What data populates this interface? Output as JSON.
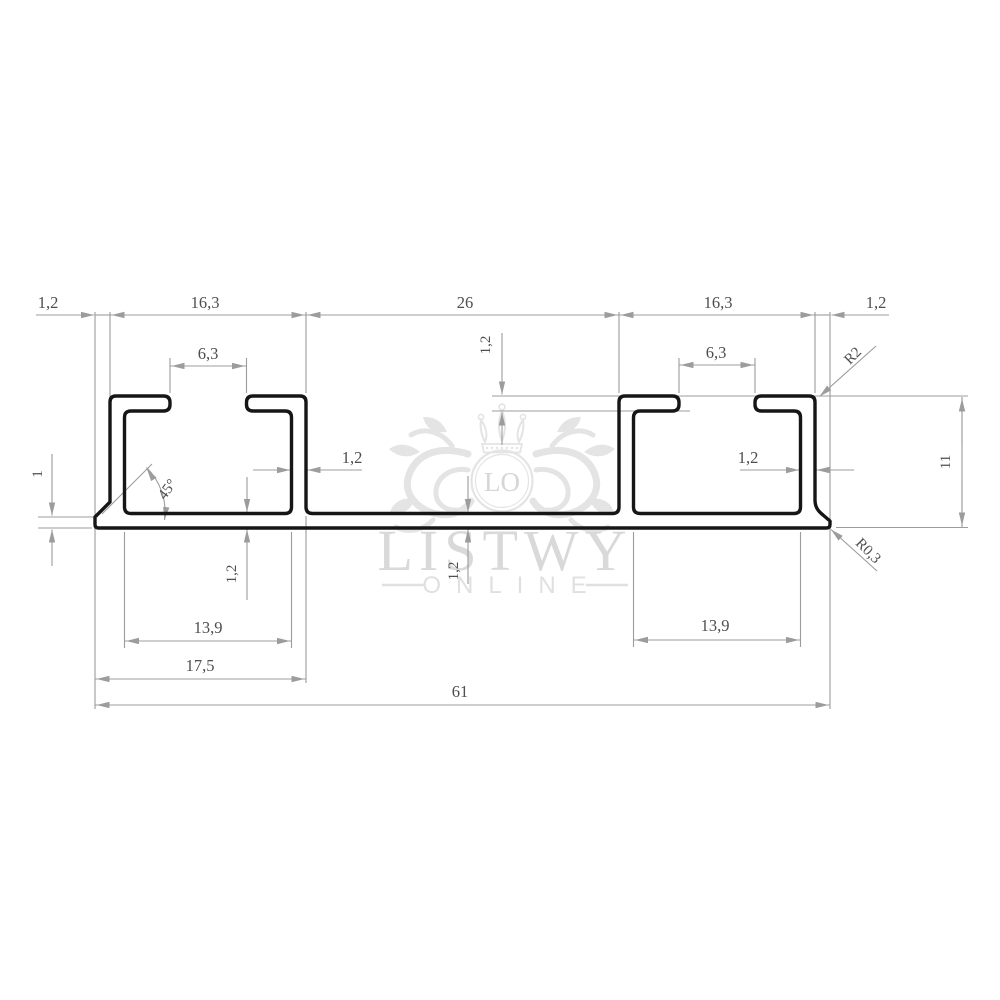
{
  "watermark": {
    "monogram": "LO",
    "brand": "LISTWY",
    "tagline": "ONLINE"
  },
  "dims": {
    "top_left_foot": "1,2",
    "top_left_channel": "16,3",
    "top_center_gap": "26",
    "top_right_channel": "16,3",
    "top_right_foot": "1,2",
    "left_opening": "6,3",
    "right_opening": "6,3",
    "lip_thickness": "1,2",
    "left_wall_thickness": "1,2",
    "right_wall_thickness": "1,2",
    "chamfer_angle": "45°",
    "left_edge_height": "1",
    "left_base_thickness": "1,2",
    "center_base_thickness": "1,2",
    "top_corner_radius": "R2",
    "profile_height": "11",
    "bottom_corner_radius": "R0,3",
    "left_inner_width": "13,9",
    "right_inner_width": "13,9",
    "left_section_width": "17,5",
    "total_width": "61"
  }
}
